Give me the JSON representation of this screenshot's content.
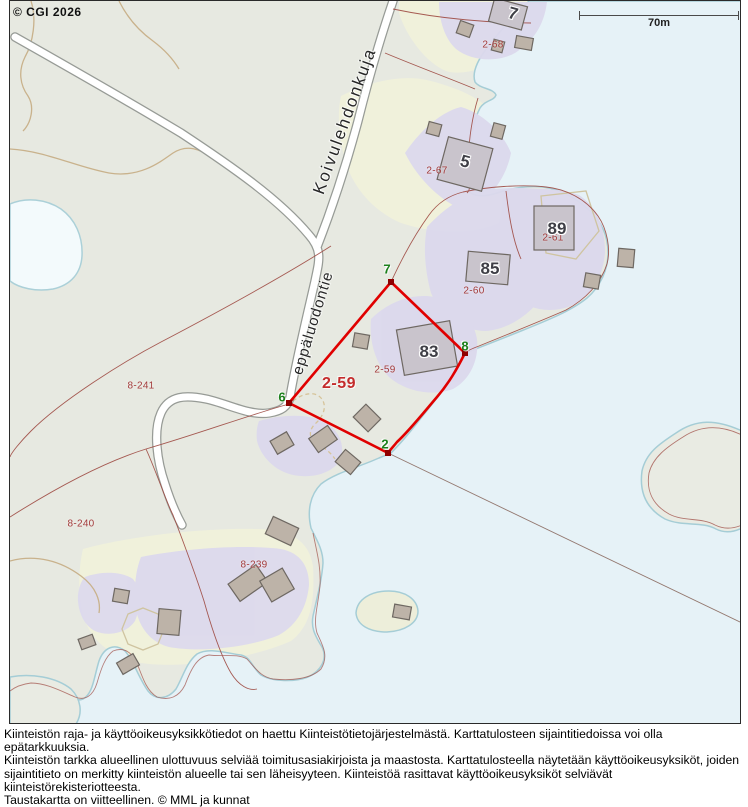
{
  "map": {
    "copyright": "© CGI 2026",
    "scale": {
      "label": "70m"
    },
    "road_labels": [
      {
        "name": "koivulehdonkuja",
        "text": "Koivulehdonkuja"
      },
      {
        "name": "leppaluodontie",
        "text": "eppäluodontie"
      }
    ],
    "highlight_parcel": {
      "label": "2-59"
    },
    "parcel_labels": [
      {
        "text": "2-68"
      },
      {
        "text": "2-67"
      },
      {
        "text": "2-60"
      },
      {
        "text": "2-61"
      },
      {
        "text": "2-59"
      },
      {
        "text": "8-241"
      },
      {
        "text": "8-240"
      },
      {
        "text": "8-239"
      }
    ],
    "boundary_point_labels": [
      {
        "text": "7"
      },
      {
        "text": "8"
      },
      {
        "text": "2"
      },
      {
        "text": "6"
      }
    ],
    "building_labels": [
      {
        "text": "7"
      },
      {
        "text": "5"
      },
      {
        "text": "85"
      },
      {
        "text": "89"
      },
      {
        "text": "83"
      }
    ],
    "colors": {
      "highlight_boundary": "#e00000",
      "cadastral_line": "#9e4a42",
      "parcel_label": "#a33b3b",
      "vertex_label": "#1c801c",
      "water": "#e6f2f7",
      "land": "#e7e9e1",
      "yard": "#dcd9ed",
      "field": "#f0f1db"
    }
  },
  "footer": {
    "lines": [
      "Kiinteistön raja- ja käyttöoikeusyksikkötiedot on haettu Kiinteistötietojärjestelmästä. Karttatulosteen sijaintitiedoissa voi olla epätarkkuuksia.",
      "Kiinteistön tarkka alueellinen ulottuvuus selviää toimitusasiakirjoista ja maastosta. Karttatulosteella näytetään käyttöoikeusyksiköt, joiden",
      "sijaintitieto on merkitty kiinteistön alueelle tai sen läheisyyteen. Kiinteistöä rasittavat käyttöoikeusyksiköt selviävät kiinteistörekisteriotteesta.",
      "Taustakartta on viitteellinen. © MML ja kunnat"
    ]
  }
}
